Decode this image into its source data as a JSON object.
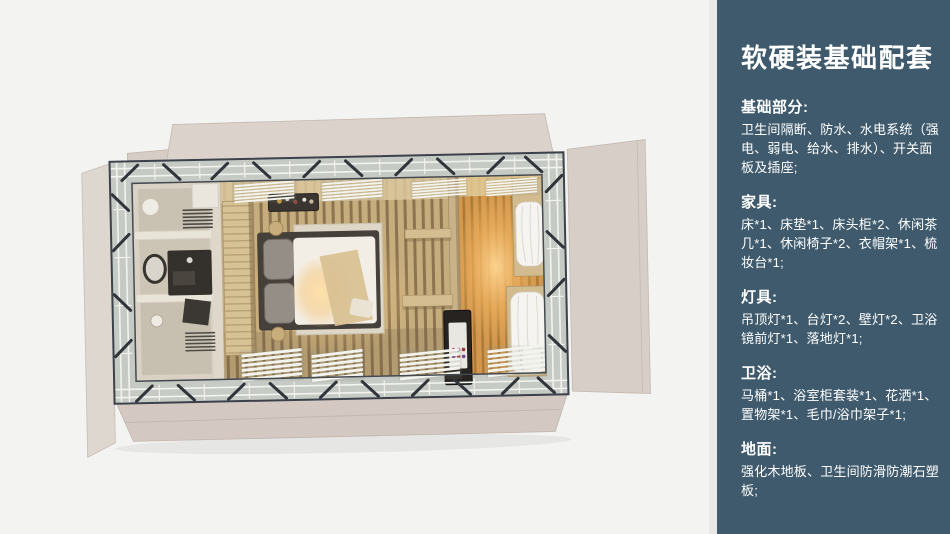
{
  "panel": {
    "title": "软硬装基础配套",
    "colors": {
      "background": "#3e5a6c",
      "text": "#ffffff"
    },
    "sections": [
      {
        "heading": "基础部分:",
        "body": "卫生间隔断、防水、水电系统（强电、弱电、给水、排水）、开关面板及插座;"
      },
      {
        "heading": "家具:",
        "body": "床*1、床垫*1、床头柜*2、休闲茶几*1、休闲椅子*2、衣帽架*1、梳妆台*1;"
      },
      {
        "heading": "灯具:",
        "body": "吊顶灯*1、台灯*2、壁灯*2、卫浴镜前灯*1、落地灯*1;"
      },
      {
        "heading": "卫浴:",
        "body": "马桶*1、浴室柜套装*1、花洒*1、置物架*1、毛巾/浴巾架子*1;"
      },
      {
        "heading": "地面:",
        "body": "强化木地板、卫生间防滑防潮石塑板;"
      }
    ]
  },
  "floorplan": {
    "kind": "top-down-3d-room-render",
    "colors": {
      "canvas_bg": "#f3f3f2",
      "flap_panel": "#d9d1ca",
      "steel_frame": "#3c414a",
      "frame_band": "#c6cac4",
      "wood_floor": "#c2a06c",
      "warm_wood_floor": "#d3984e",
      "warm_glow": "#f2b968",
      "bathroom_cabinet": "#d8d1c4",
      "bed_duvet": "#f3eee5",
      "curtain": "#f6f4f0"
    }
  }
}
